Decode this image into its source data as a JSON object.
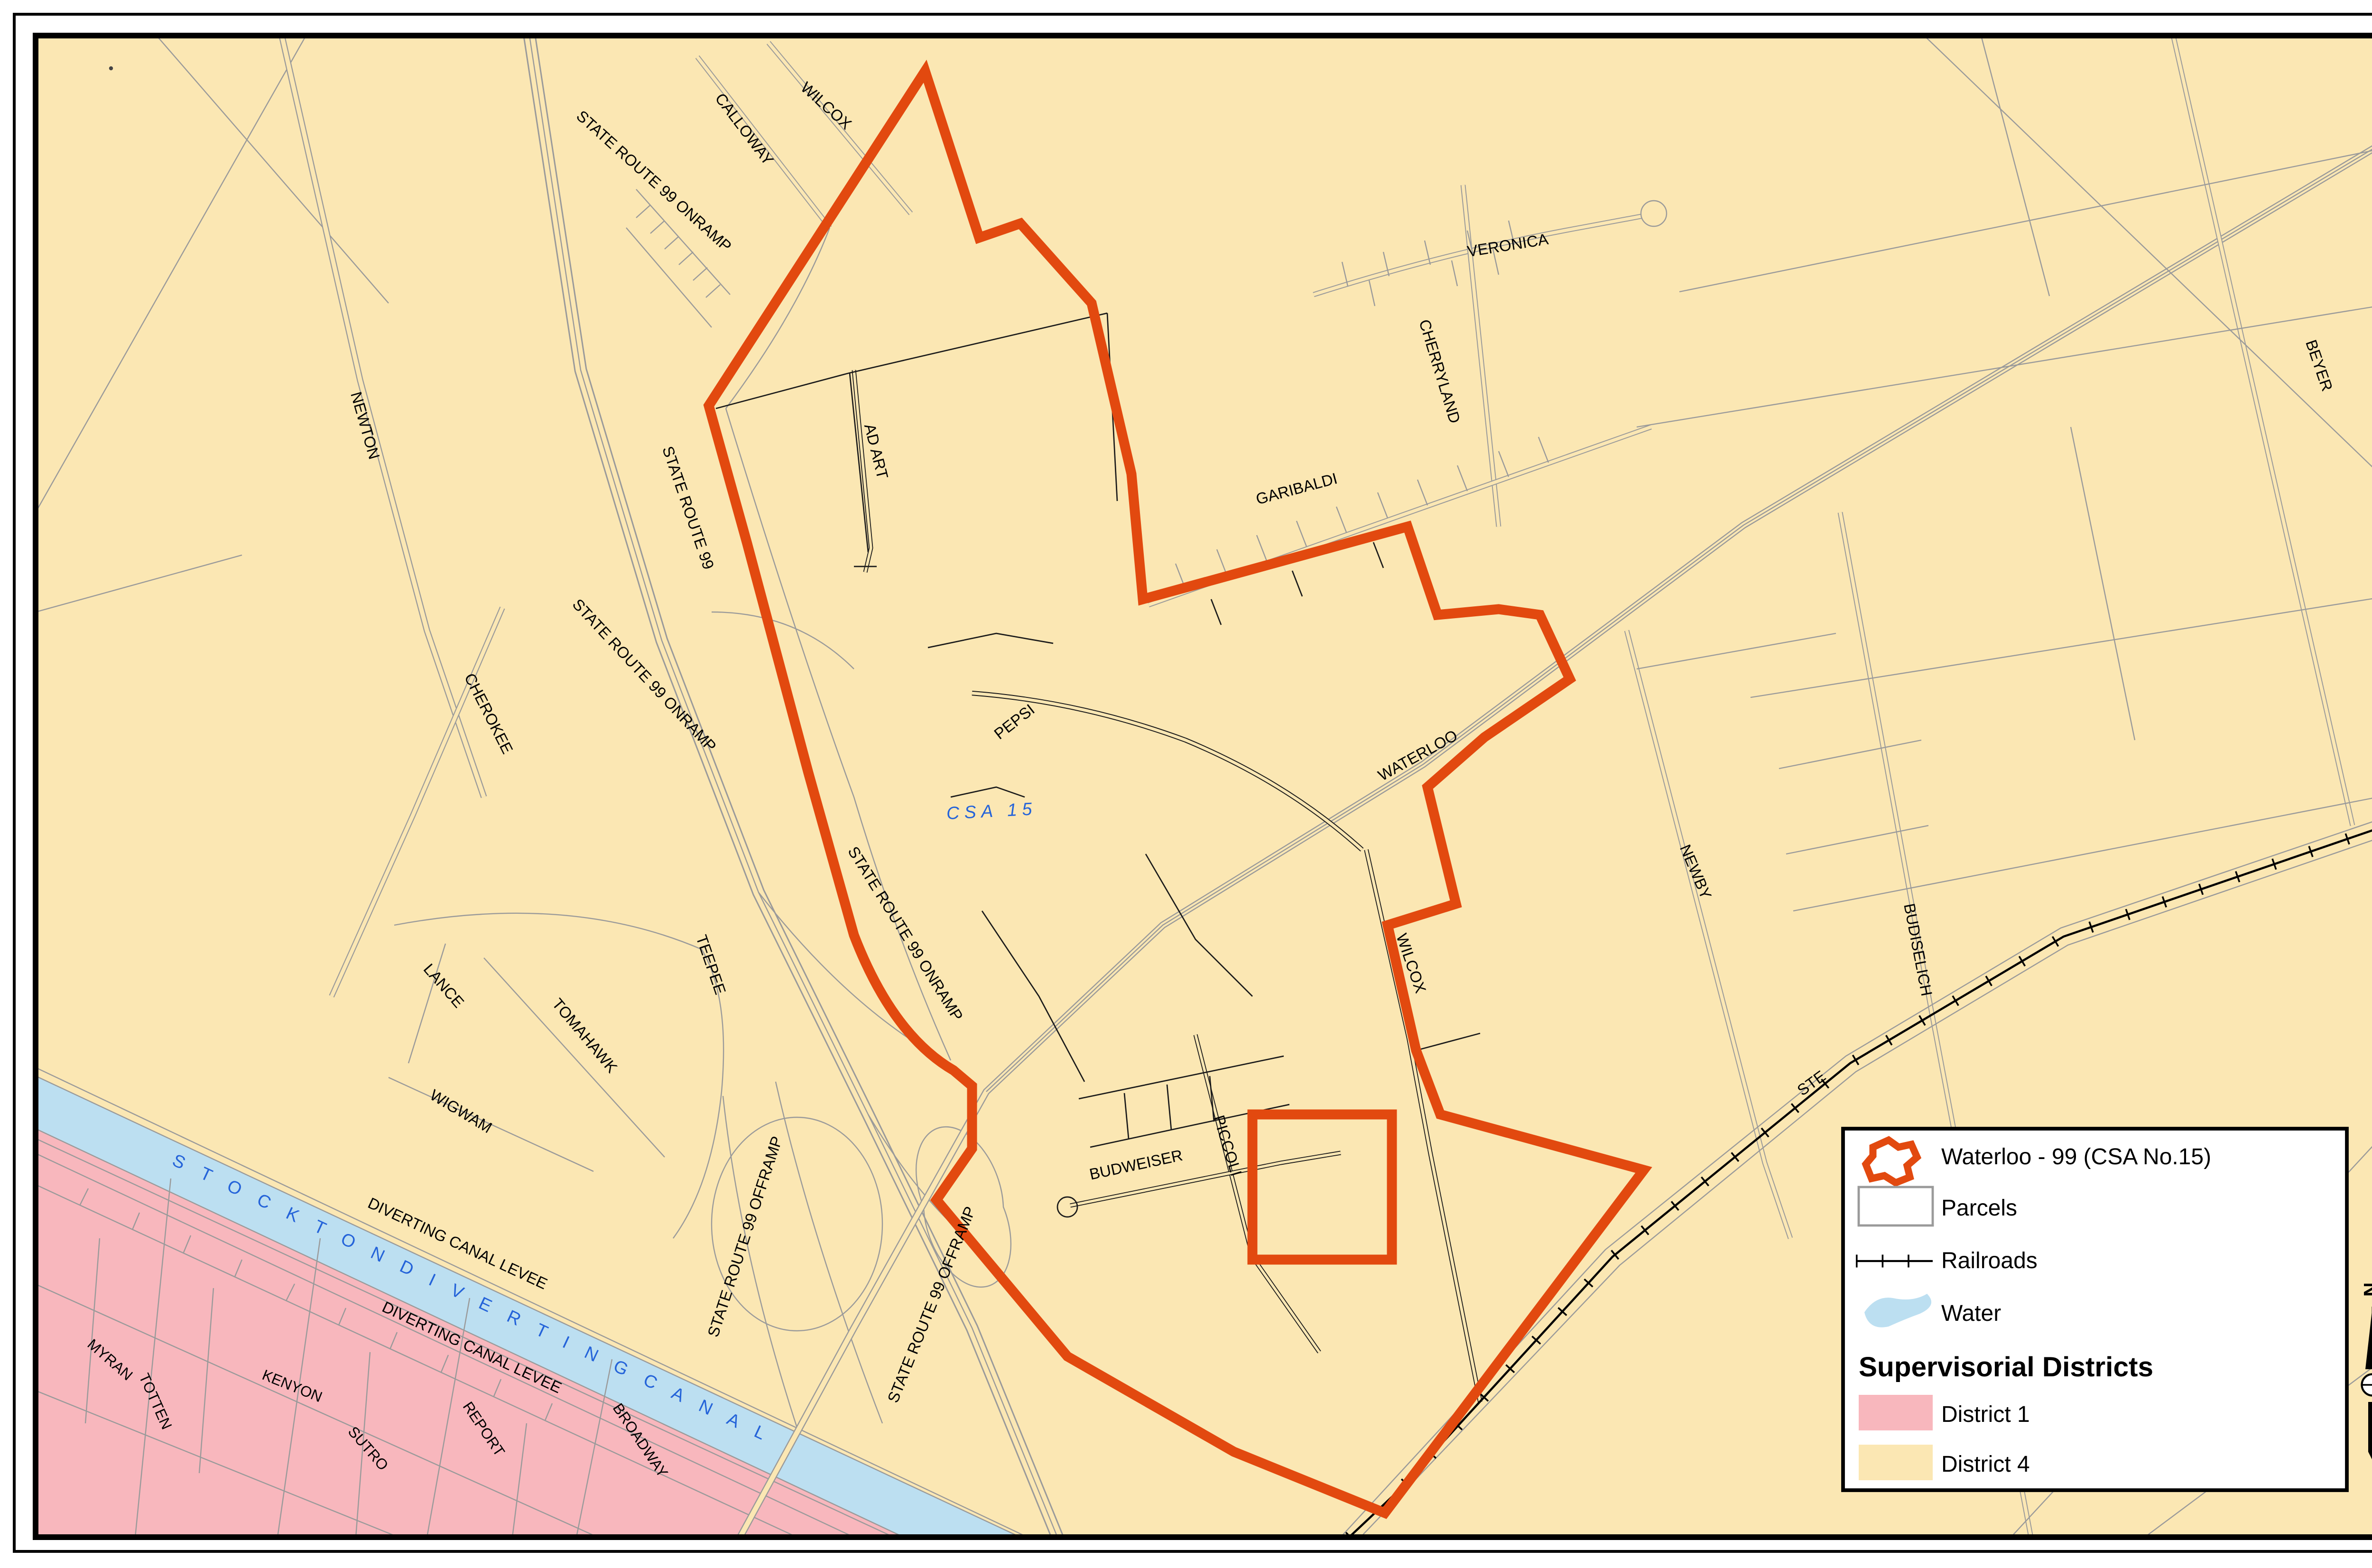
{
  "labels": {
    "calloway": "CALLOWAY",
    "wilcox_top": "WILCOX",
    "newton": "NEWTON",
    "cherokee": "CHEROKEE",
    "state_route_99": "STATE ROUTE 99",
    "state_route_99_onramp_a": "STATE ROUTE 99 ONRAMP",
    "state_route_99_onramp_b": "STATE ROUTE 99 ONRAMP",
    "state_route_99_onramp_c": "STATE ROUTE 99 ONRAMP",
    "state_route_99_offramp_a": "STATE ROUTE 99 OFFRAMP",
    "state_route_99_offramp_b": "STATE ROUTE 99 OFFRAMP",
    "ad_art": "AD ART",
    "pepsi": "PEPSI",
    "csa_15": "CSA 15",
    "veronica": "VERONICA",
    "cherryland": "CHERRYLAND",
    "garibaldi": "GARIBALDI",
    "waterloo": "WATERLOO",
    "wilcox_mid": "WILCOX",
    "newby": "NEWBY",
    "budiselich": "BUDISELICH",
    "beyer": "BEYER",
    "ste": "STE",
    "piccoli": "PICCOLI",
    "budweiser": "BUDWEISER",
    "wigwam": "WIGWAM",
    "lance": "LANCE",
    "tomahawk": "TOMAHAWK",
    "teepee": "TEEPEE",
    "myran": "MYRAN",
    "totten": "TOTTEN",
    "kenyon": "KENYON",
    "sutro": "SUTRO",
    "report": "REPORT",
    "broadway": "BROADWAY",
    "diverting_canal_levee_upper": "DIVERTING CANAL LEVEE",
    "diverting_canal_levee_lower": "DIVERTING CANAL LEVEE",
    "stockton_diverting_canal": "S T O C K T O N   D I V E R T I N G   C A N A L"
  },
  "legend": {
    "waterloo_csa": "Waterloo - 99 (CSA No.15)",
    "parcels": "Parcels",
    "railroads": "Railroads",
    "water": "Water",
    "districts_title": "Supervisorial Districts",
    "district1": "District 1",
    "district4": "District 4",
    "north": "N"
  },
  "colors": {
    "csa_boundary": "#E2490F",
    "district1": "#F8B7BD",
    "district4": "#FBE7B3",
    "water": "#BCDFF1",
    "canal_text": "#2463D9",
    "parcel_outside": "#9A9A9A",
    "parcel_inside": "#1A1A1A"
  }
}
